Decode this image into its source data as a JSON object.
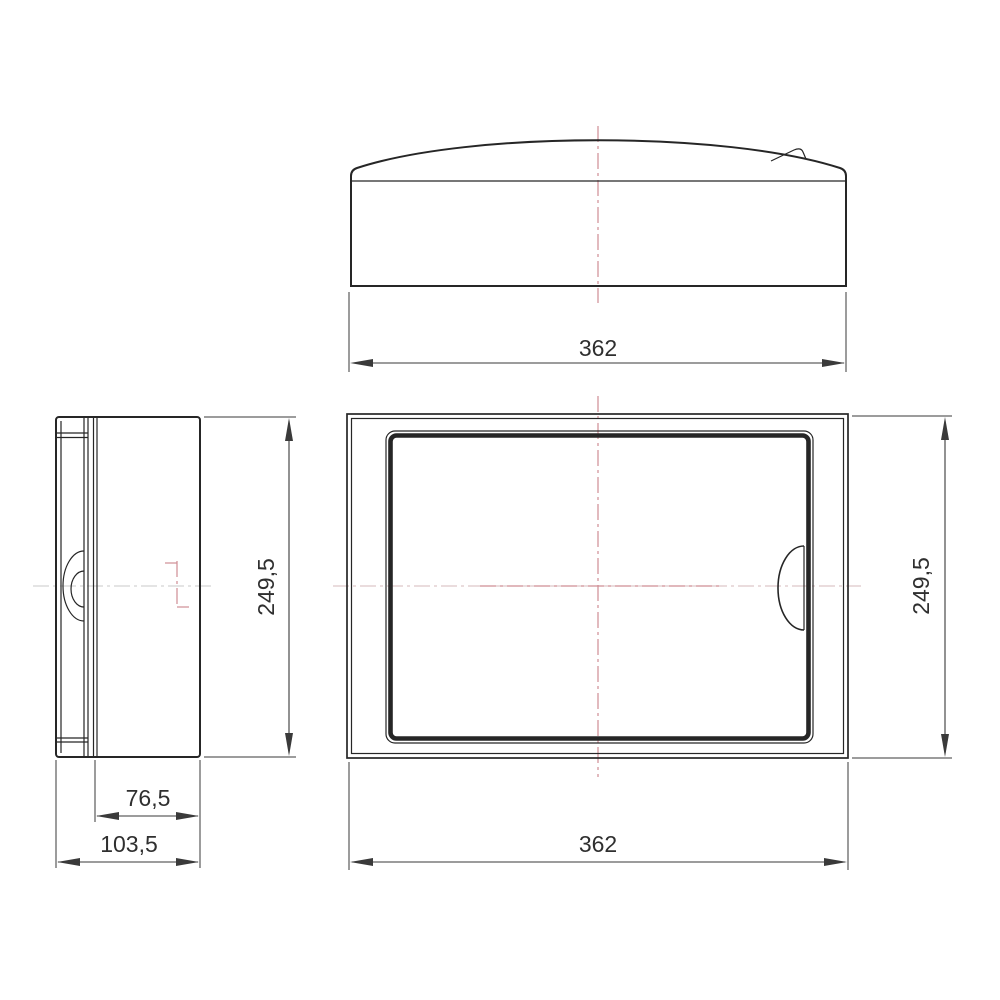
{
  "drawing": {
    "type": "technical-drawing-three-views",
    "subject": "wall-mounted enclosure / distribution box",
    "dimensions": {
      "top_width": "362",
      "front_width": "362",
      "front_height": "249,5",
      "side_height": "249,5",
      "side_depth_body": "76,5",
      "side_depth_total": "103,5"
    }
  },
  "colors": {
    "background": "#ffffff",
    "line_color": "#262626",
    "dim_color": "#3a3a3a",
    "text_color": "#2f2f2f",
    "centerline_red": "#cf8d94",
    "centerline_grey": "#c9c9c9",
    "centerline_pinkgrey": "#d6b8bb"
  }
}
